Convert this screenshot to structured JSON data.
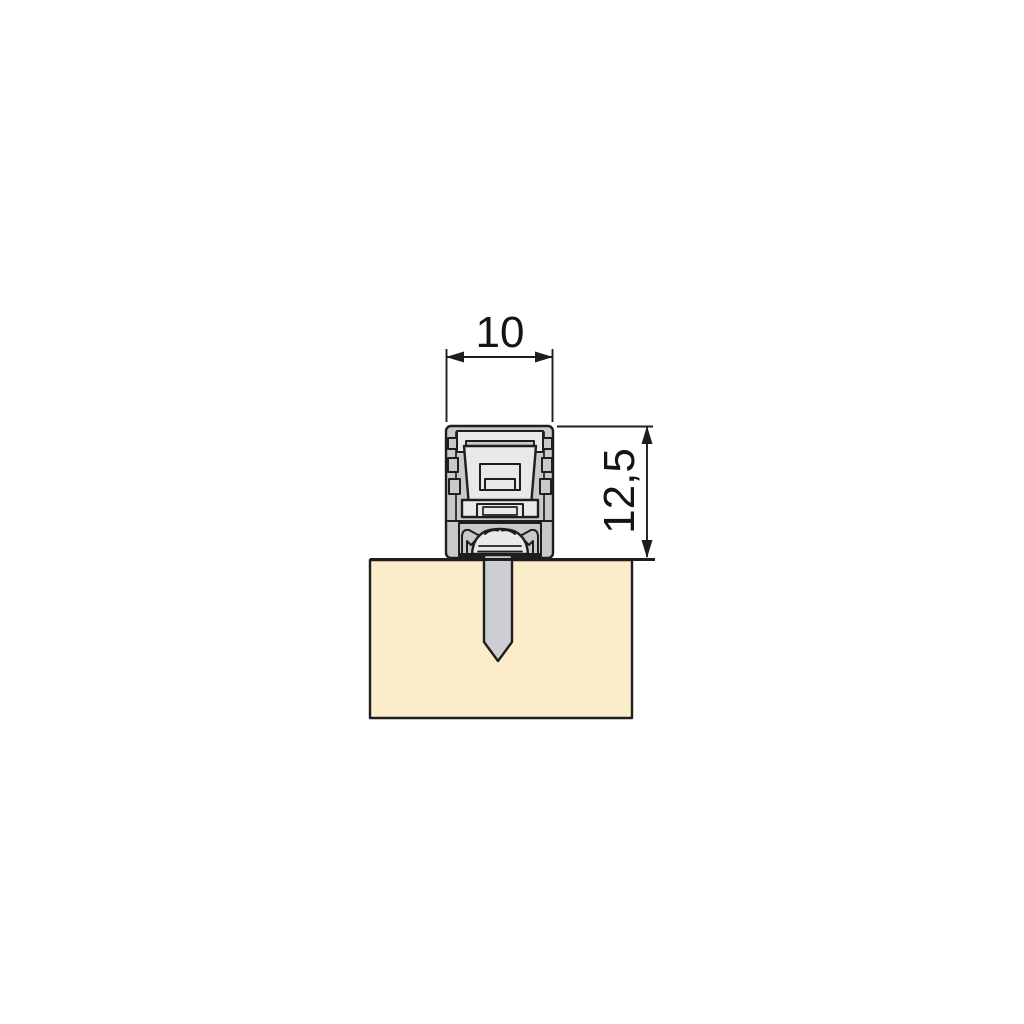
{
  "diagram": {
    "kind": "technical-cross-section-drawing",
    "dimensions": {
      "width_label": "10",
      "height_label": "12,5"
    },
    "colors": {
      "outline": "#1e1e1e",
      "profile_body": "#c9c9ca",
      "insert": "#e9e9e9",
      "pin": "#cdced1",
      "panel": "#fbecca",
      "background": "#ffffff"
    }
  }
}
